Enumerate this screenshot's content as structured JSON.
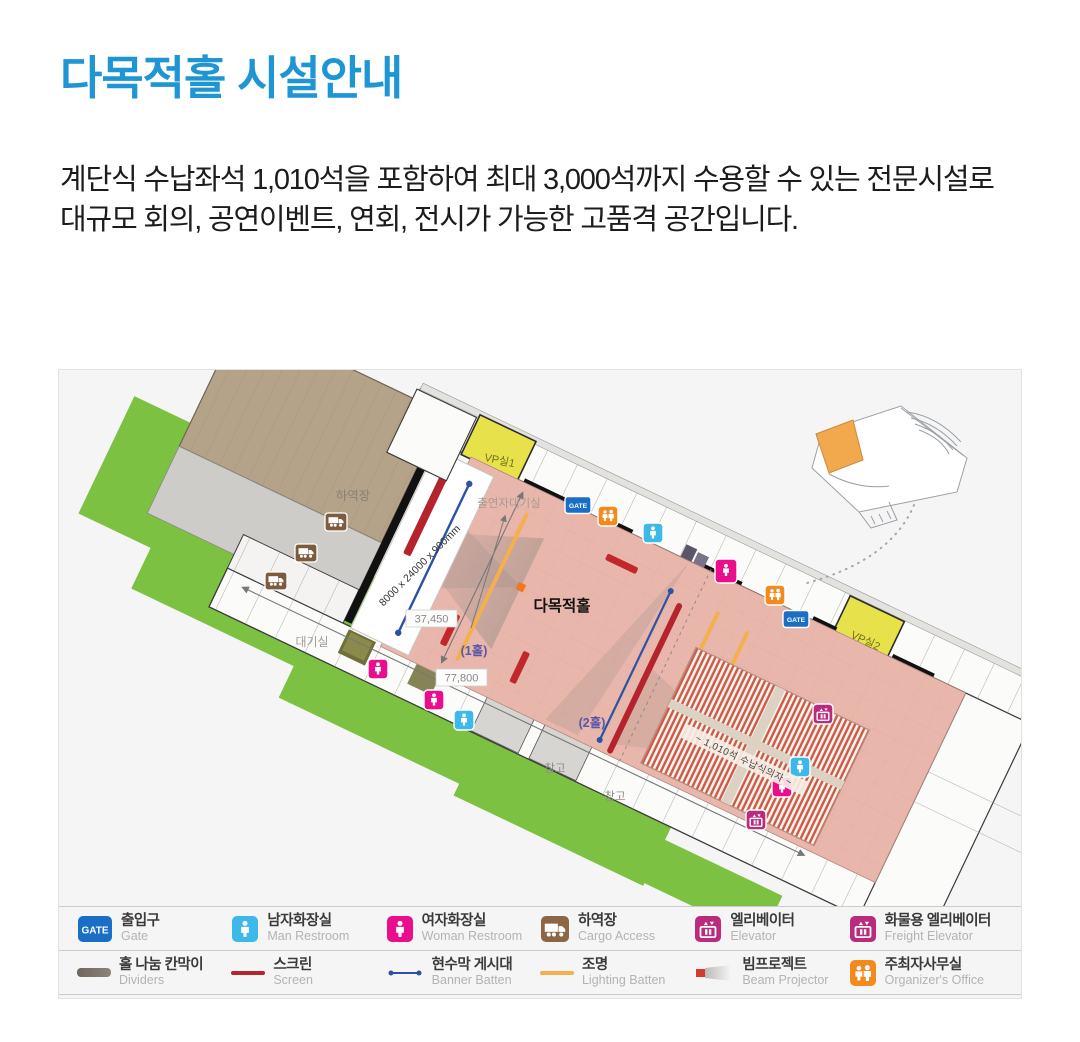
{
  "page": {
    "title": "다목적홀 시설안내",
    "description": "계단식 수납좌석 1,010석을 포함하여 최대 3,000석까지 수용할 수 있는 전문시설로 대규모 회의, 공연이벤트, 연회, 전시가 가능한 고품격 공간입니다."
  },
  "plan": {
    "labels": {
      "hall_name": "다목적홀",
      "loading_dock": "하역장",
      "vip1": "VP실1",
      "vip2": "VP실2",
      "performer_room": "출연자대기실",
      "waiting_room": "대기실",
      "storage1": "창고",
      "storage2": "창고",
      "hall1": "(1홀)",
      "hall2": "(2홀)",
      "dim_width": "37,450",
      "dim_length": "77,800",
      "stage_size": "8000 x 24000 x 900mm",
      "seating": "~ 1,010석 수납식의자 ~",
      "gate": "GATE"
    },
    "colors": {
      "hall_floor": "#e9b6ab",
      "lawn": "#7cc142",
      "dock": "#b4a289",
      "vip": "#e8e24a",
      "gate_blue": "#1a6ec5",
      "man_blue": "#3cb9e8",
      "woman_pink": "#ea0e8c",
      "cargo_brown": "#8c6744",
      "elevator_magenta": "#ba2a7d",
      "organizer_orange": "#f28a1e",
      "screen_red": "#b5232d",
      "banner_blue": "#2d52a5",
      "lighting_orange": "#f3b04c"
    }
  },
  "legend": {
    "rows": [
      [
        {
          "icon": "gate",
          "ko": "출입구",
          "en": "Gate"
        },
        {
          "icon": "man-restroom",
          "ko": "남자화장실",
          "en": "Man Restroom"
        },
        {
          "icon": "woman-restroom",
          "ko": "여자화장실",
          "en": "Woman Restroom"
        },
        {
          "icon": "cargo",
          "ko": "하역장",
          "en": "Cargo Access"
        },
        {
          "icon": "elevator",
          "ko": "엘리베이터",
          "en": "Elevator"
        },
        {
          "icon": "freight-elevator",
          "ko": "화물용 엘리베이터",
          "en": "Freight Elevator"
        }
      ],
      [
        {
          "icon": "dividers",
          "ko": "홀 나눔 칸막이",
          "en": "Dividers"
        },
        {
          "icon": "screen",
          "ko": "스크린",
          "en": "Screen"
        },
        {
          "icon": "banner",
          "ko": "현수막 게시대",
          "en": "Banner Batten"
        },
        {
          "icon": "lighting",
          "ko": "조명",
          "en": "Lighting Batten"
        },
        {
          "icon": "beam-projector",
          "ko": "빔프로젝트",
          "en": "Beam Projector"
        },
        {
          "icon": "organizer",
          "ko": "주최자사무실",
          "en": "Organizer's Office"
        }
      ]
    ]
  }
}
